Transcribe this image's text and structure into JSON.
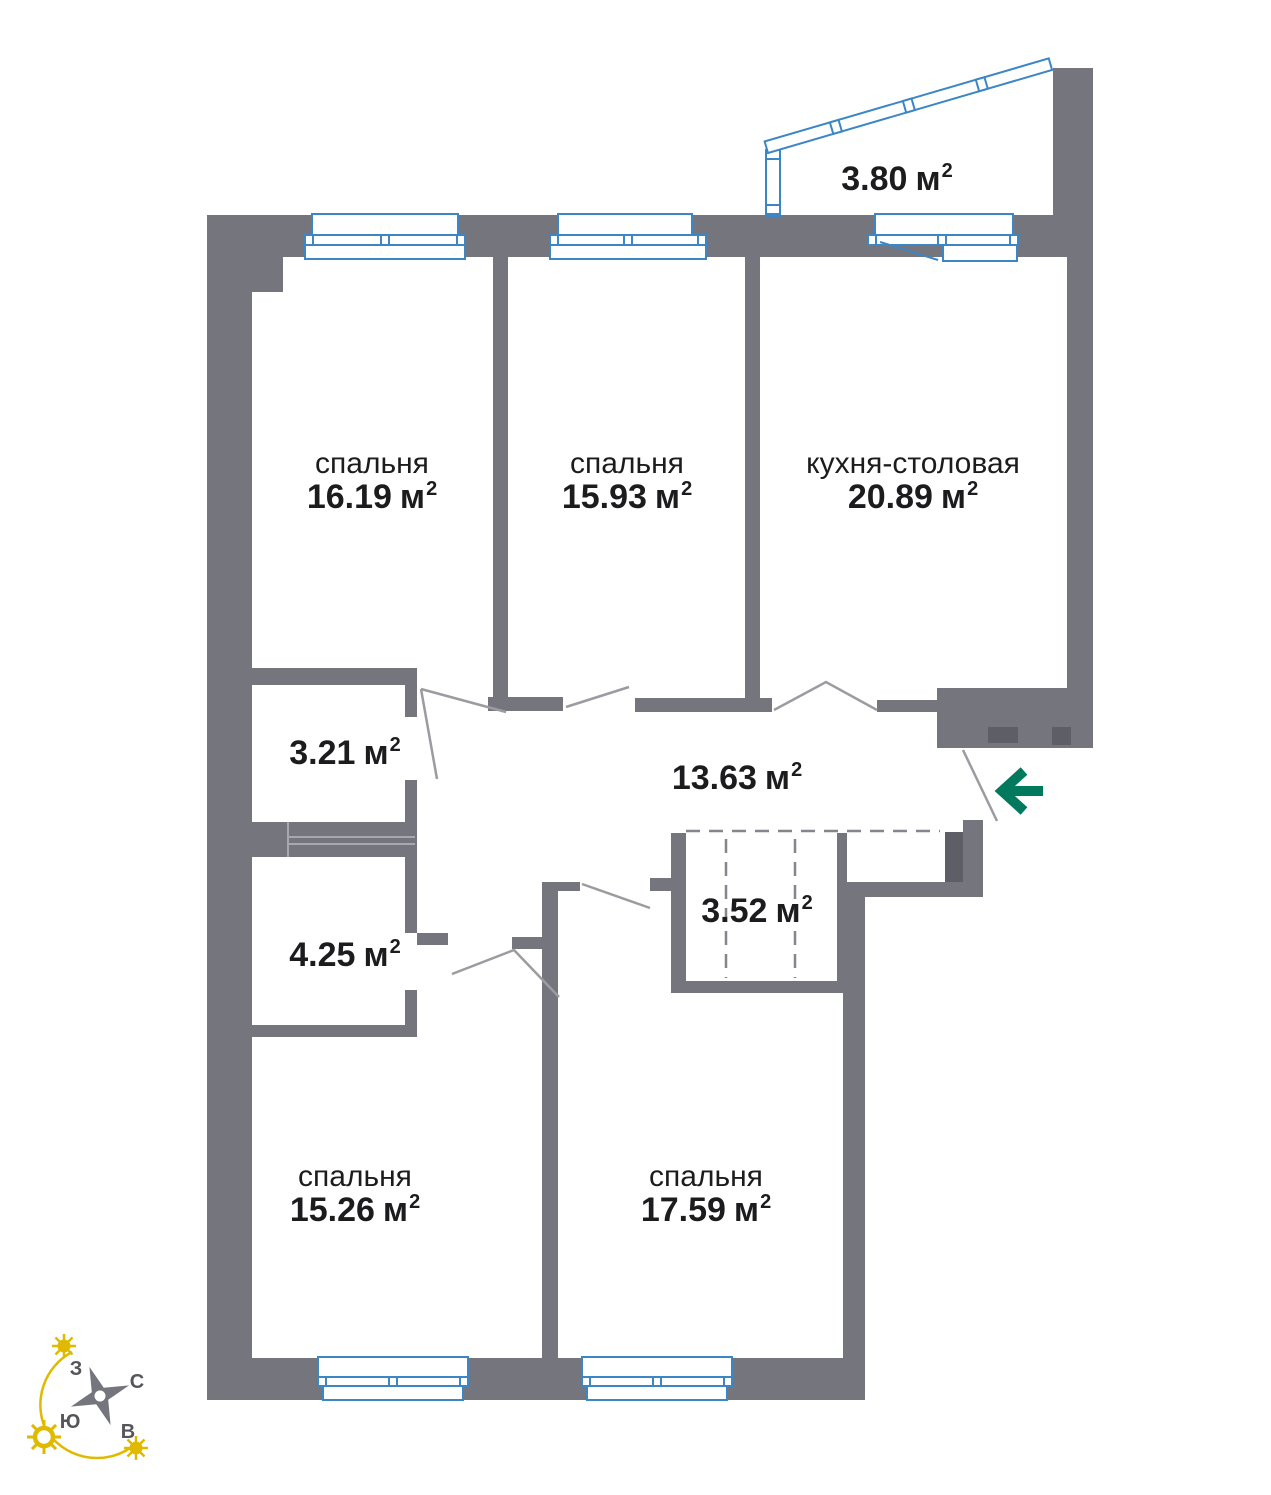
{
  "plan": {
    "unit": "м",
    "unit_sup": "2",
    "rooms": [
      {
        "id": "bedroom-1",
        "name": "спальня",
        "area": "16.19"
      },
      {
        "id": "bedroom-2",
        "name": "спальня",
        "area": "15.93"
      },
      {
        "id": "kitchen-dining",
        "name": "кухня-столовая",
        "area": "20.89"
      },
      {
        "id": "balcony",
        "name": "",
        "area": "3.80"
      },
      {
        "id": "hall-small",
        "name": "",
        "area": "3.21"
      },
      {
        "id": "hallway",
        "name": "",
        "area": "13.63"
      },
      {
        "id": "storage",
        "name": "",
        "area": "4.25"
      },
      {
        "id": "wardrobe",
        "name": "",
        "area": "3.52"
      },
      {
        "id": "bedroom-3",
        "name": "спальня",
        "area": "15.26"
      },
      {
        "id": "bedroom-4",
        "name": "спальня",
        "area": "17.59"
      }
    ]
  },
  "compass": {
    "north": "С",
    "east": "В",
    "south": "Ю",
    "west": "З"
  },
  "colors": {
    "wall": "#75757D",
    "wall_dark": "#5E5E66",
    "window": "#3C86C5",
    "door_line": "#9B9BA1",
    "dash_line": "#85858D",
    "shaft_line": "#A7A7AD",
    "entry_arrow": "#00795D",
    "sun": "#DFBA00",
    "text": "#1C1C1E",
    "compass_label": "#55555C"
  }
}
